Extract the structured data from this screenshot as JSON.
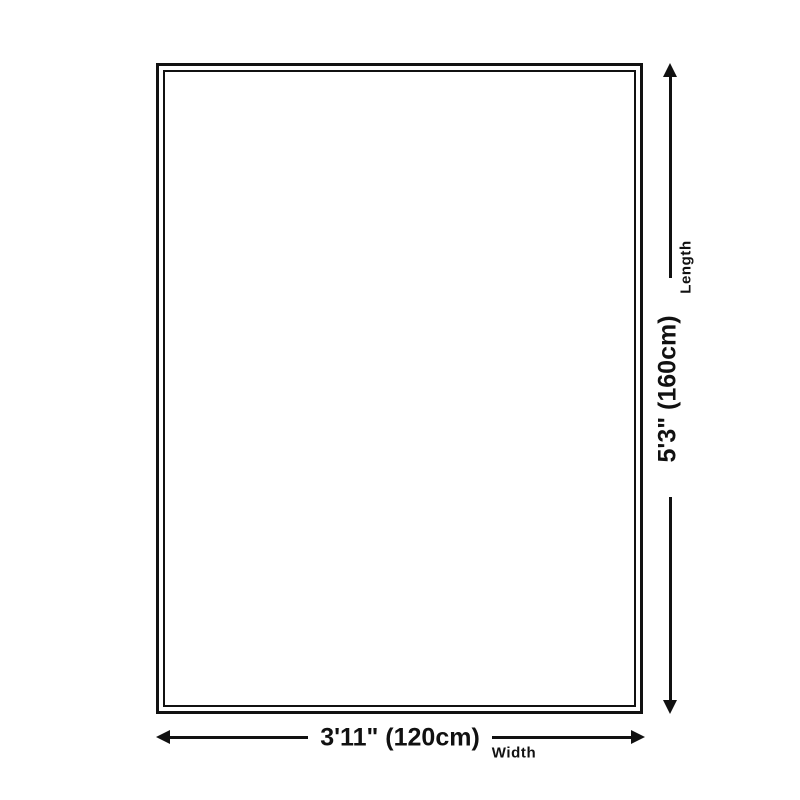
{
  "page": {
    "background": "#ffffff",
    "ink_color": "#111111"
  },
  "diagram": {
    "type": "product-dimension-diagram",
    "shape": "rectangle-double-border",
    "length_dimension": {
      "value": "5'3\" (160cm)",
      "label": "Length",
      "orientation": "vertical"
    },
    "width_dimension": {
      "value": "3'11\" (120cm)",
      "label": "Width",
      "orientation": "horizontal"
    }
  }
}
